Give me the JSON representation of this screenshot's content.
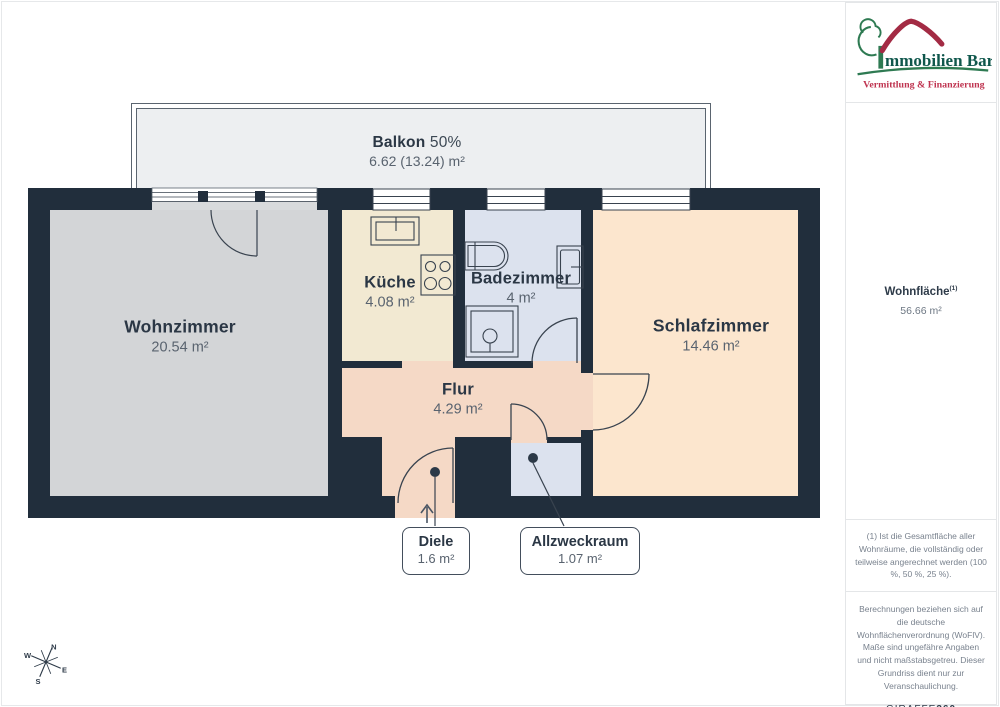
{
  "plan": {
    "balcony": {
      "name": "Balkon",
      "share": "50%",
      "area": "6.62 (13.24) m²"
    },
    "rooms": {
      "wohnzimmer": {
        "name": "Wohnzimmer",
        "area": "20.54 m²"
      },
      "kueche": {
        "name": "Küche",
        "area": "4.08 m²"
      },
      "badezimmer": {
        "name": "Badezimmer",
        "area": "4 m²"
      },
      "schlafzimmer": {
        "name": "Schlafzimmer",
        "area": "14.46 m²"
      },
      "flur": {
        "name": "Flur",
        "area": "4.29 m²"
      },
      "diele": {
        "name": "Diele",
        "area": "1.6 m²"
      },
      "allzweckraum": {
        "name": "Allzweckraum",
        "area": "1.07 m²"
      }
    },
    "compass": {
      "n": "N",
      "e": "E",
      "s": "S",
      "w": "W"
    }
  },
  "sidebar": {
    "logo": {
      "title": "Immobilien Bart",
      "title_rest": "mmobilien Bart",
      "subtitle": "Vermittlung & Finanzierung"
    },
    "living_area": {
      "label": "Wohnfläche",
      "sup": "(1)",
      "value": "56.66 m²"
    },
    "footnote1": "(1) Ist die Gesamtfläche aller Wohnräume, die vollständig oder teilweise angerechnet werden (100 %, 50 %, 25 %).",
    "footnote2": "Berechnungen beziehen sich auf die deutsche Wohnflächenverordnung (WoFlV). Maße sind ungefähre Angaben und nicht maßstabsgetreu. Dieser Grundriss dient nur zur Veranschaulichung.",
    "brand": {
      "name": "GIRAFFE",
      "suffix": "360"
    }
  },
  "colors": {
    "wall": "#212e3c",
    "wohnzimmer": "#d3d5d7",
    "kueche": "#f2e9d2",
    "badezimmer": "#dce2ee",
    "schlafzimmer": "#fce6ce",
    "flur": "#f5d9c6",
    "balkon": "#edeff1",
    "label_dark": "#2b3745",
    "label_gray": "#59636f",
    "logo_green": "#2e7a52",
    "logo_text": "#0f574c",
    "logo_roof_red": "#a32b44",
    "logo_subtitle_red": "#bf3450"
  }
}
